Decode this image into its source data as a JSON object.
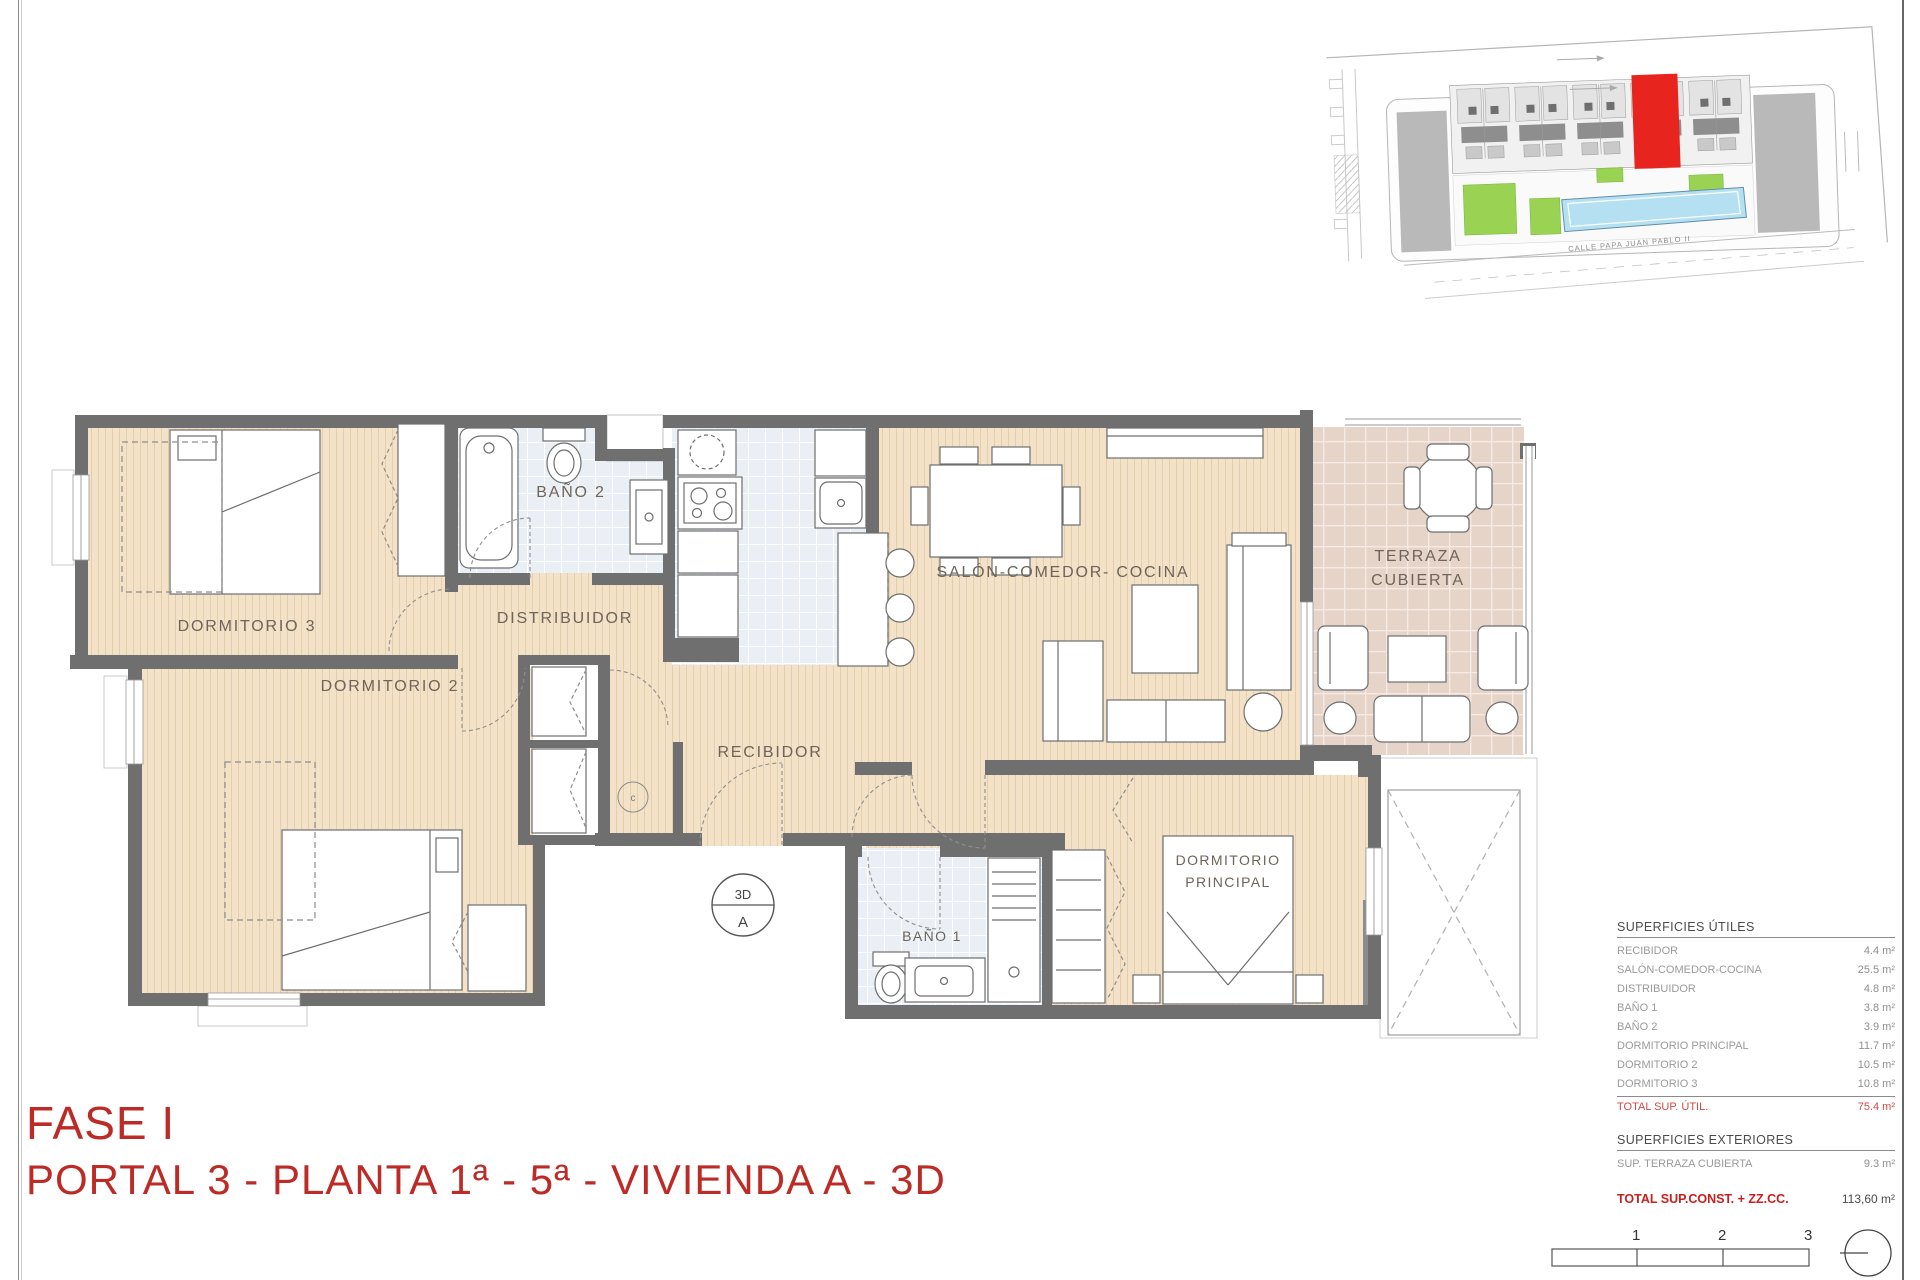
{
  "page": {
    "fase_title": "FASE I",
    "portal_title": "PORTAL 3 - PLANTA 1ª - 5ª - VIVIENDA A - 3D"
  },
  "floor_plan": {
    "labels": {
      "dormitorio3": "DORMITORIO 3",
      "dormitorio2": "DORMITORIO 2",
      "bano2": "BAÑO 2",
      "distribuidor": "DISTRIBUIDOR",
      "recibidor": "RECIBIDOR",
      "salon": "SALÓN-COMEDOR- COCINA",
      "terraza_line1": "TERRAZA",
      "terraza_line2": "CUBIERTA",
      "bano1": "BAÑO 1",
      "dormp_line1": "DORMITORIO",
      "dormp_line2": "PRINCIPAL",
      "unit_marker_top": "3D",
      "unit_marker_bottom": "A",
      "closet_marker": "c"
    }
  },
  "site_plan": {
    "street_label": "CALLE PAPA JUAN PABLO II"
  },
  "tables": {
    "utiles": {
      "title": "SUPERFICIES ÚTILES",
      "rows": [
        {
          "label": "RECIBIDOR",
          "value": "4.4 m²"
        },
        {
          "label": "SALÓN-COMEDOR-COCINA",
          "value": "25.5 m²"
        },
        {
          "label": "DISTRIBUIDOR",
          "value": "4.8 m²"
        },
        {
          "label": "BAÑO 1",
          "value": "3.8 m²"
        },
        {
          "label": "BAÑO 2",
          "value": "3.9 m²"
        },
        {
          "label": "DORMITORIO PRINCIPAL",
          "value": "11.7 m²"
        },
        {
          "label": "DORMITORIO 2",
          "value": "10.5 m²"
        },
        {
          "label": "DORMITORIO 3",
          "value": "10.8 m²"
        }
      ],
      "total_label": "TOTAL SUP. ÚTIL.",
      "total_value": "75.4 m²"
    },
    "exteriores": {
      "title": "SUPERFICIES EXTERIORES",
      "rows": [
        {
          "label": "SUP. TERRAZA CUBIERTA",
          "value": "9.3 m²"
        }
      ]
    },
    "total_const": {
      "label": "TOTAL SUP.CONST. + ZZ.CC.",
      "value": "113,60 m²"
    }
  },
  "scale_bar": {
    "ticks": [
      "1",
      "2",
      "3"
    ]
  },
  "colors": {
    "title_red": "#bd2b27",
    "table_red": "#c9201d",
    "highlight_unit_red": "#e8241f",
    "wall_gray": "#6f6f6f",
    "wood_floor": "#f3e2c8",
    "tile_floor": "#e9eff4",
    "terrace_floor": "#e7d4c9",
    "pool_blue": "#b5e0f2",
    "garden_green": "#9ad353"
  }
}
